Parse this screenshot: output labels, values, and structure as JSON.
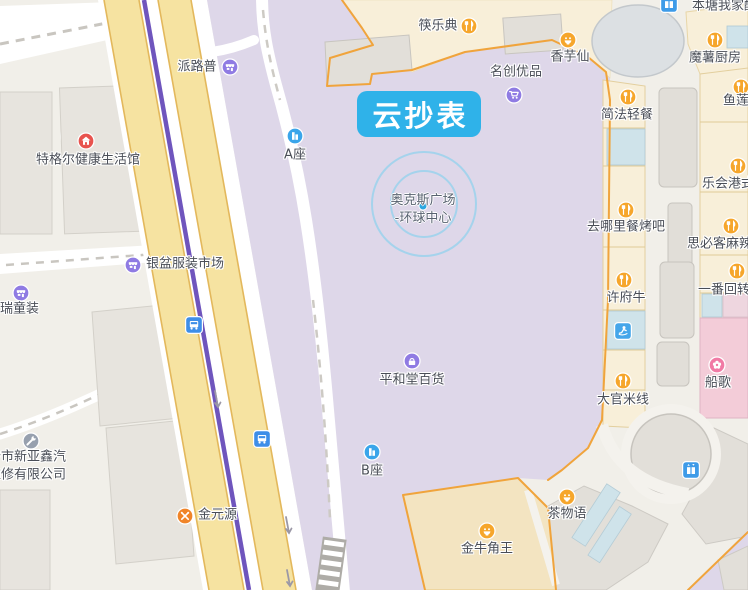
{
  "selected_poi": {
    "label": "云抄表"
  },
  "plaza_poi": {
    "line1": "奥克斯广场",
    "line2": "-环球中心"
  },
  "colors": {
    "selected_label_bg": "#2FB2E9",
    "selected_label_text": "#FFFFFF",
    "plaza_fill": "#DED7E9",
    "road_fill": "#F6E3A1",
    "road_casing": "#E3B85C",
    "metro_line": "#6F55BD",
    "mall_outline": "#F0A43C",
    "poi_orange": "#F6A62B",
    "poi_purple": "#8F7BE3",
    "poi_blue": "#3AA5EA",
    "poi_red": "#E8534E",
    "poi_pink": "#F17AA5"
  },
  "pois": [
    {
      "name": "poi-kuailedian",
      "label": "筷乐典",
      "icon": "restaurant",
      "ix": 469,
      "iy": 26,
      "tx": 438,
      "ty": 26,
      "align": "c"
    },
    {
      "name": "poi-xiangyuxian",
      "label": "香芋仙",
      "icon": "dessert",
      "ix": 568,
      "iy": 40,
      "tx": 570,
      "ty": 57,
      "align": "c"
    },
    {
      "name": "poi-mingchuangyoupin",
      "label": "名创优品",
      "icon": "cart",
      "ix": 514,
      "iy": 95,
      "tx": 516,
      "ty": 72,
      "align": "c"
    },
    {
      "name": "poi-moshuchufang",
      "label": "魔薯厨房",
      "icon": "restaurant",
      "ix": 715,
      "iy": 40,
      "tx": 715,
      "ty": 58,
      "align": "c"
    },
    {
      "name": "poi-bentangwojia",
      "label": "本塘我家酸",
      "tx": 692,
      "ty": 6,
      "align": "l"
    },
    {
      "name": "poi-elevator-top",
      "icon": "elevator",
      "ix": 669,
      "iy": 4
    },
    {
      "name": "poi-yulian",
      "label": "鱼莲",
      "icon": "restaurant",
      "ix": 741,
      "iy": 87,
      "tx": 736,
      "ty": 101,
      "align": "c"
    },
    {
      "name": "poi-jianfaqingcan",
      "label": "简法轻餐",
      "icon": "restaurant",
      "ix": 628,
      "iy": 97,
      "tx": 627,
      "ty": 115,
      "align": "c"
    },
    {
      "name": "poi-lehuigangshi",
      "label": "乐会港式",
      "icon": "restaurant",
      "ix": 738,
      "iy": 166,
      "tx": 702,
      "ty": 184,
      "align": "l"
    },
    {
      "name": "poi-qunalicankaoba",
      "label": "去哪里餐烤吧",
      "icon": "restaurant",
      "ix": 626,
      "iy": 210,
      "tx": 626,
      "ty": 227,
      "align": "c"
    },
    {
      "name": "poi-sibikemala",
      "label": "思必客麻辣",
      "icon": "restaurant",
      "ix": 731,
      "iy": 226,
      "tx": 687,
      "ty": 244,
      "align": "l"
    },
    {
      "name": "poi-yifanhuizhuan",
      "label": "一番回转",
      "icon": "restaurant",
      "ix": 737,
      "iy": 271,
      "tx": 698,
      "ty": 290,
      "align": "l"
    },
    {
      "name": "poi-xufuniu",
      "label": "许府牛",
      "icon": "restaurant",
      "ix": 624,
      "iy": 280,
      "tx": 626,
      "ty": 298,
      "align": "c"
    },
    {
      "name": "poi-leisure",
      "icon": "person",
      "ix": 623,
      "iy": 331
    },
    {
      "name": "poi-daguanmixian",
      "label": "大官米线",
      "icon": "restaurant",
      "ix": 623,
      "iy": 381,
      "tx": 623,
      "ty": 400,
      "align": "c"
    },
    {
      "name": "poi-chuange",
      "label": "船歌",
      "icon": "flower",
      "ix": 717,
      "iy": 365,
      "tx": 718,
      "ty": 383,
      "align": "c"
    },
    {
      "name": "poi-elevator-mall",
      "icon": "elevator",
      "ix": 691,
      "iy": 470
    },
    {
      "name": "poi-chawuyu",
      "label": "茶物语",
      "icon": "dessert",
      "ix": 567,
      "iy": 497,
      "tx": 567,
      "ty": 514,
      "align": "c"
    },
    {
      "name": "poi-jinniujiaowang",
      "label": "金牛角王",
      "icon": "dessert",
      "ix": 487,
      "iy": 531,
      "tx": 487,
      "ty": 549,
      "align": "c"
    },
    {
      "name": "poi-b-zuo",
      "label": "B座",
      "icon": "building",
      "ix": 372,
      "iy": 452,
      "tx": 372,
      "ty": 471,
      "align": "c"
    },
    {
      "name": "poi-a-zuo",
      "label": "A座",
      "icon": "building",
      "ix": 295,
      "iy": 136,
      "tx": 295,
      "ty": 155,
      "align": "c"
    },
    {
      "name": "poi-pinghetangbaihuo",
      "label": "平和堂百货",
      "icon": "bag",
      "ix": 412,
      "iy": 361,
      "tx": 412,
      "ty": 380,
      "align": "c"
    },
    {
      "name": "poi-pailupu",
      "label": "派路普",
      "icon": "market",
      "ix": 230,
      "iy": 67,
      "tx": 197,
      "ty": 67,
      "align": "c"
    },
    {
      "name": "poi-tegeer",
      "label": "特格尔健康生活馆",
      "icon": "house",
      "ix": 86,
      "iy": 141,
      "tx": 88,
      "ty": 160,
      "align": "c"
    },
    {
      "name": "poi-yinpenfuzhuang",
      "label": "银盆服装市场",
      "icon": "market",
      "ix": 133,
      "iy": 265,
      "tx": 146,
      "ty": 264,
      "align": "l"
    },
    {
      "name": "poi-ruitongzhuang",
      "label": "均瑞童装",
      "icon": "market",
      "ix": 21,
      "iy": 293,
      "tx": -13,
      "ty": 309,
      "align": "l"
    },
    {
      "name": "poi-qichexiuli",
      "label": "沙市新亚鑫汽",
      "label2": "维修有限公司",
      "icon": "wrench",
      "ix": 31,
      "iy": 441,
      "tx": -12,
      "ty": 457,
      "align": "l"
    },
    {
      "name": "poi-jinyuanyuan",
      "label": "金元源",
      "icon": "restaurant-cross",
      "ix": 185,
      "iy": 516,
      "tx": 198,
      "ty": 515,
      "align": "l"
    },
    {
      "name": "poi-bus-stop-1",
      "icon": "bus",
      "ix": 194,
      "iy": 325
    },
    {
      "name": "poi-bus-stop-2",
      "icon": "bus",
      "ix": 262,
      "iy": 439
    }
  ]
}
